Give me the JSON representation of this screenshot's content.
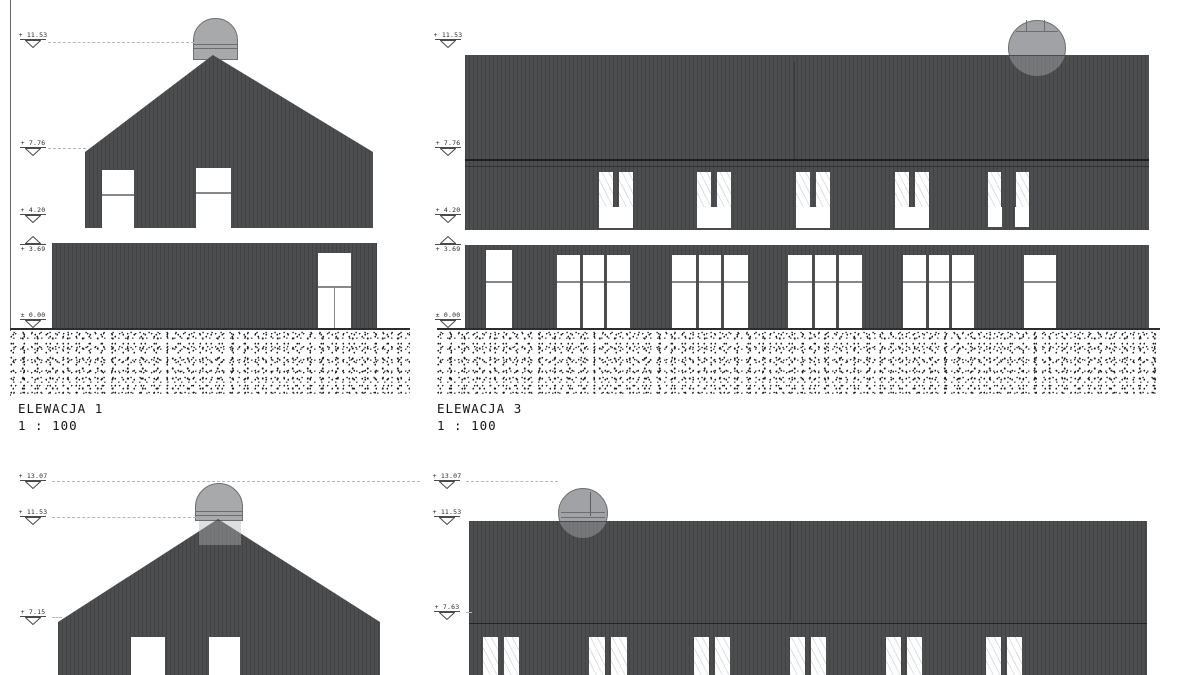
{
  "drawing": {
    "colors": {
      "facade": "#4b4d4f",
      "chimney": "#a7a9ab",
      "paper": "#ffffff",
      "ink": "#141414"
    },
    "elevations": [
      {
        "name": "ELEWACJA 1",
        "scale": "1 : 100",
        "markers": [
          "+ 11.53",
          "+ 7.76",
          "+ 4.20",
          "+ 3.69",
          "± 0.00"
        ]
      },
      {
        "name": "ELEWACJA 3",
        "scale": "1 : 100",
        "markers": [
          "+ 11.53",
          "+ 7.76",
          "+ 4.20",
          "+ 3.69",
          "± 0.00"
        ]
      },
      {
        "markers": [
          "+ 13.07",
          "+ 11.53",
          "+ 7.15"
        ]
      },
      {
        "markers": [
          "+ 13.07",
          "+ 11.53",
          "+ 7.63"
        ]
      }
    ]
  }
}
